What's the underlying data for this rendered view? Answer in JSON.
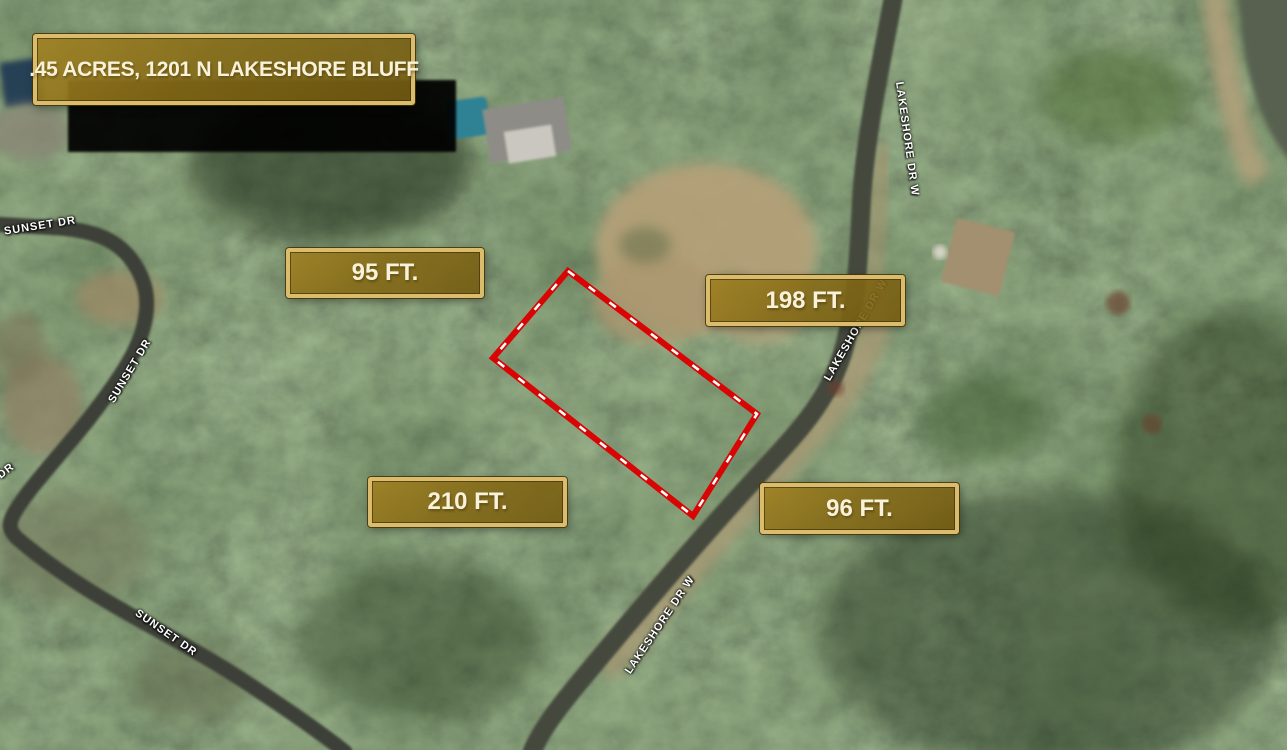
{
  "map": {
    "title": ".45 ACRES, 1201 N LAKESHORE BLUFF",
    "dimensions": {
      "side_nw": "95 FT.",
      "side_ne": "198 FT.",
      "side_sw": "210 FT.",
      "side_se": "96 FT."
    },
    "streets": {
      "sunset_top": "SUNSET DR",
      "sunset_mid": "SUNSET DR",
      "sunset_edge_partial": "DR",
      "sunset_bottom": "SUNSET DR",
      "lakeshore_top": "LAKESHORE DR W",
      "lakeshore_mid": "LAKESHORE DR W",
      "lakeshore_bottom": "LAKESHORE DR W"
    },
    "colors": {
      "banner_fill": "#8a6e17",
      "banner_border": "#dabc6c",
      "banner_text": "#f8f2da",
      "boundary_outline": "#d90404",
      "boundary_dashes": "#ffffff"
    }
  }
}
